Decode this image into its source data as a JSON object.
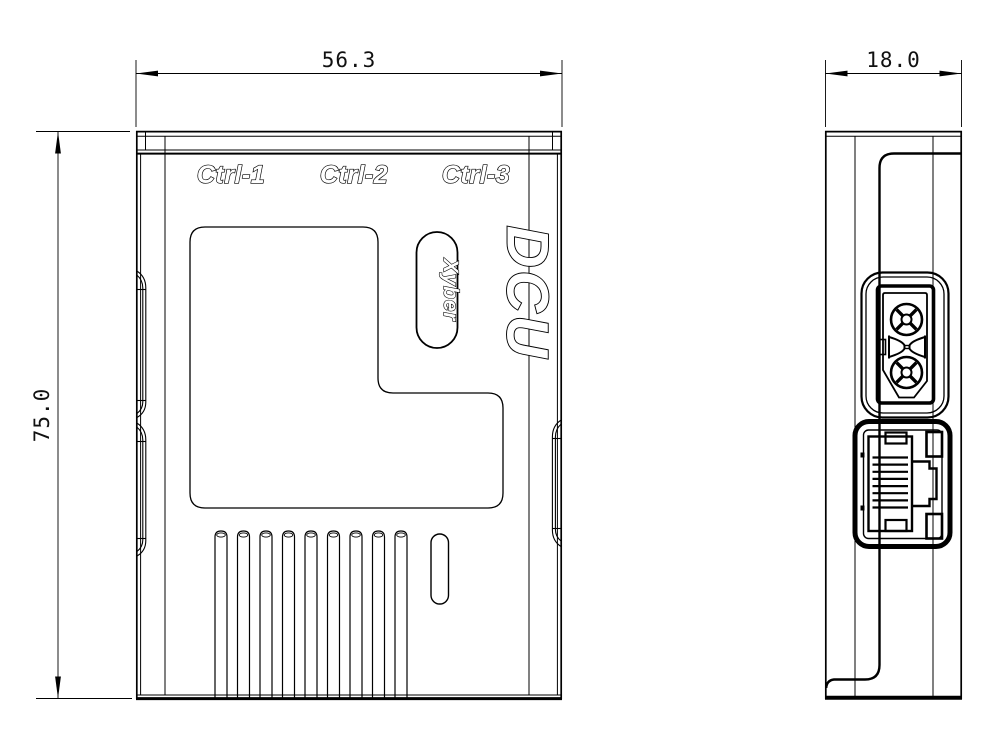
{
  "page": {
    "background": "#ffffff",
    "line_color": "#000000"
  },
  "front_view": {
    "width_dimension": "56.3",
    "height_dimension": "75.0",
    "port_labels": [
      "Ctrl-1",
      "Ctrl-2",
      "Ctrl-3"
    ],
    "product_name": "DCU",
    "brand_name": "Xyber"
  },
  "side_view": {
    "depth_dimension": "18.0"
  }
}
